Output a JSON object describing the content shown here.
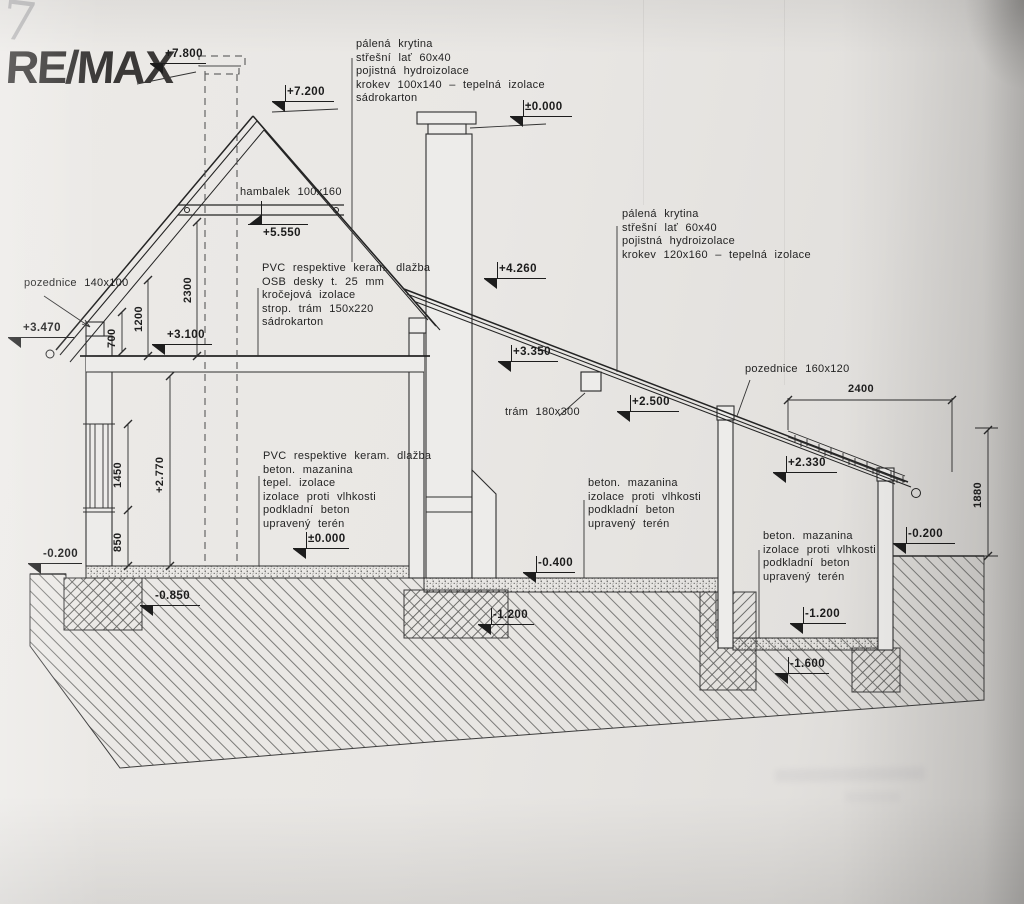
{
  "brand": {
    "logo": "RE/MAX",
    "handwritten_mark": "7"
  },
  "blocks": {
    "roof_main": {
      "lines": [
        "pálená krytina",
        "střešní lať 60x40",
        "pojistná hydroizolace",
        "krokev 100x140 – tepelná izolace",
        "sádrokarton"
      ]
    },
    "roof_low": {
      "lines": [
        "pálená krytina",
        "střešní lať 60x40",
        "pojistná hydroizolace",
        "krokev 120x160 – tepelná izolace"
      ]
    },
    "ceiling": {
      "lines": [
        "PVC respektive keram. dlažba",
        "OSB desky t. 25 mm",
        "kročejová izolace",
        "strop. trám 150x220",
        "sádrokarton"
      ]
    },
    "floor_main": {
      "lines": [
        "PVC respektive keram. dlažba",
        "beton. mazanina",
        "tepel. izolace",
        "izolace proti vlhkosti",
        "podkladní beton",
        "upravený terén"
      ]
    },
    "floor_mid": {
      "lines": [
        "beton. mazanina",
        "izolace proti vlhkosti",
        "podkladní beton",
        "upravený terén"
      ]
    },
    "floor_right": {
      "lines": [
        "beton. mazanina",
        "izolace proti vlhkosti",
        "podkladní beton",
        "upravený terén"
      ]
    }
  },
  "labels": {
    "hambalek": "hambalek 100x160",
    "pozednice_left": "pozednice 140x100",
    "pozednice_right": "pozednice 160x120",
    "tram": "trám 180x300"
  },
  "elevations": {
    "e7800": "+7.800",
    "e7200": "+7.200",
    "e0000_top": "±0.000",
    "e5550": "+5.550",
    "e3470": "+3.470",
    "e3100": "+3.100",
    "e4260": "+4.260",
    "e3350": "+3.350",
    "e2500": "+2.500",
    "e2330": "+2.330",
    "e0000_floor": "±0.000",
    "e0200_left": "-0.200",
    "e0850": "-0.850",
    "e0400": "-0.400",
    "e1200_mid": "-1.200",
    "e1200_right": "-1.200",
    "e1600": "-1.600",
    "e0200_right": "-0.200"
  },
  "dimensions": {
    "d700": "700",
    "d1200": "1200",
    "d2300": "2300",
    "d1450": "1450",
    "d850": "850",
    "d2770": "+2.770",
    "d2400": "2400",
    "d1880": "1880"
  }
}
